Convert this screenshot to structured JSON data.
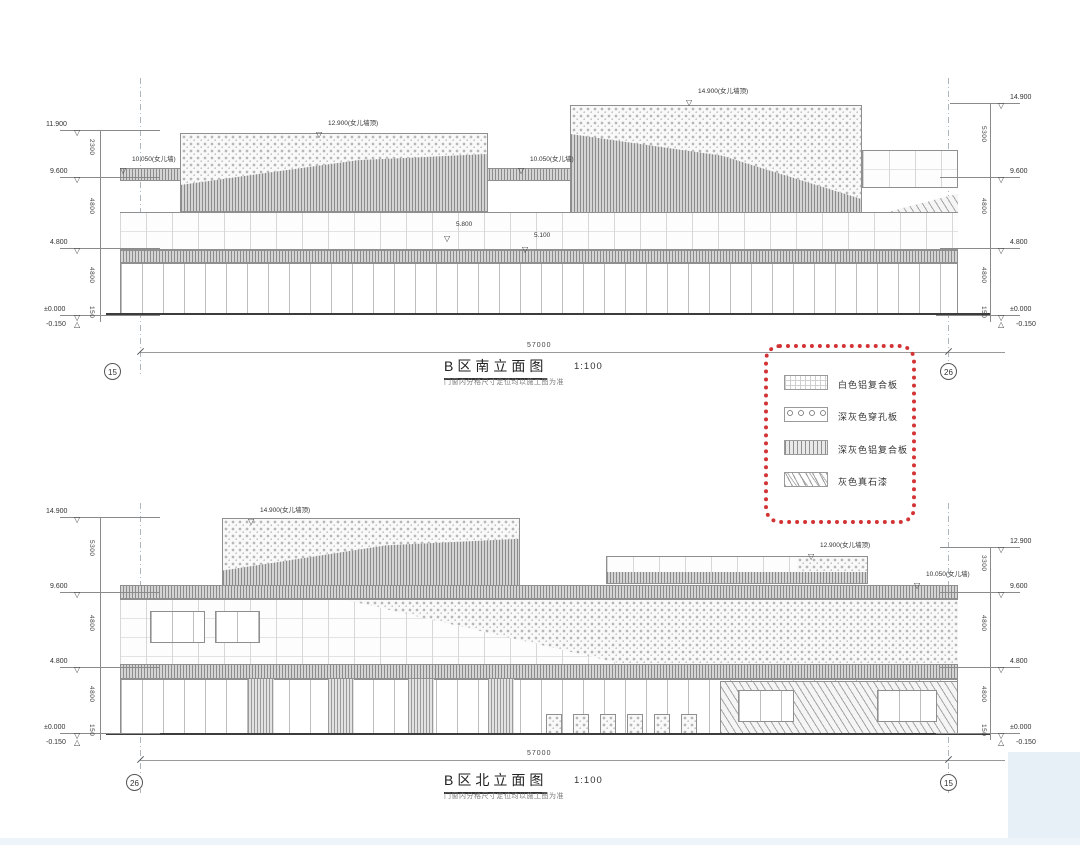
{
  "colors": {
    "revision_cloud_red": "#d23435",
    "sheet": "#ffffff",
    "margin_blue": "#e7f0f7"
  },
  "south": {
    "title": "B区南立面图",
    "scale": "1:100",
    "note": "门窗内分格尺寸定位均以施工图为准",
    "span": "57000",
    "bubble_left": "15",
    "bubble_right": "26",
    "left": {
      "levels": [
        "11.900",
        "9.600",
        "4.800",
        "±0.000",
        "-0.150"
      ],
      "dims": [
        "2300",
        "4800",
        "4800",
        "150"
      ]
    },
    "right": {
      "levels": [
        "14.900",
        "9.600",
        "4.800",
        "±0.000",
        "-0.150"
      ],
      "dims": [
        "5300",
        "4800",
        "4800",
        "150"
      ]
    },
    "annotations": [
      "12.900(女儿墙顶)",
      "14.900(女儿墙顶)",
      "10.050(女儿墙)",
      "10.050(女儿墙)",
      "5.800",
      "5.100"
    ]
  },
  "north": {
    "title": "B区北立面图",
    "scale": "1:100",
    "note": "门窗内分格尺寸定位均以施工图为准",
    "span": "57000",
    "bubble_left": "26",
    "bubble_right": "15",
    "left": {
      "levels": [
        "14.900",
        "9.600",
        "4.800",
        "±0.000",
        "-0.150"
      ],
      "dims": [
        "5300",
        "4800",
        "4800",
        "150"
      ]
    },
    "right": {
      "levels": [
        "12.900",
        "9.600",
        "4.800",
        "±0.000",
        "-0.150"
      ],
      "dims": [
        "3300",
        "4800",
        "4800",
        "150"
      ]
    },
    "annotations": [
      "14.900(女儿墙顶)",
      "12.900(女儿墙顶)",
      "10.050(女儿墙)"
    ]
  },
  "legend": {
    "items": [
      {
        "label": "白色铝复合板",
        "material": "white-aluminum-composite-panel"
      },
      {
        "label": "深灰色穿孔板",
        "material": "dark-gray-perforated-panel"
      },
      {
        "label": "深灰色铝复合板",
        "material": "dark-gray-aluminum-composite-panel"
      },
      {
        "label": "灰色真石漆",
        "material": "gray-real-stone-paint"
      }
    ]
  }
}
